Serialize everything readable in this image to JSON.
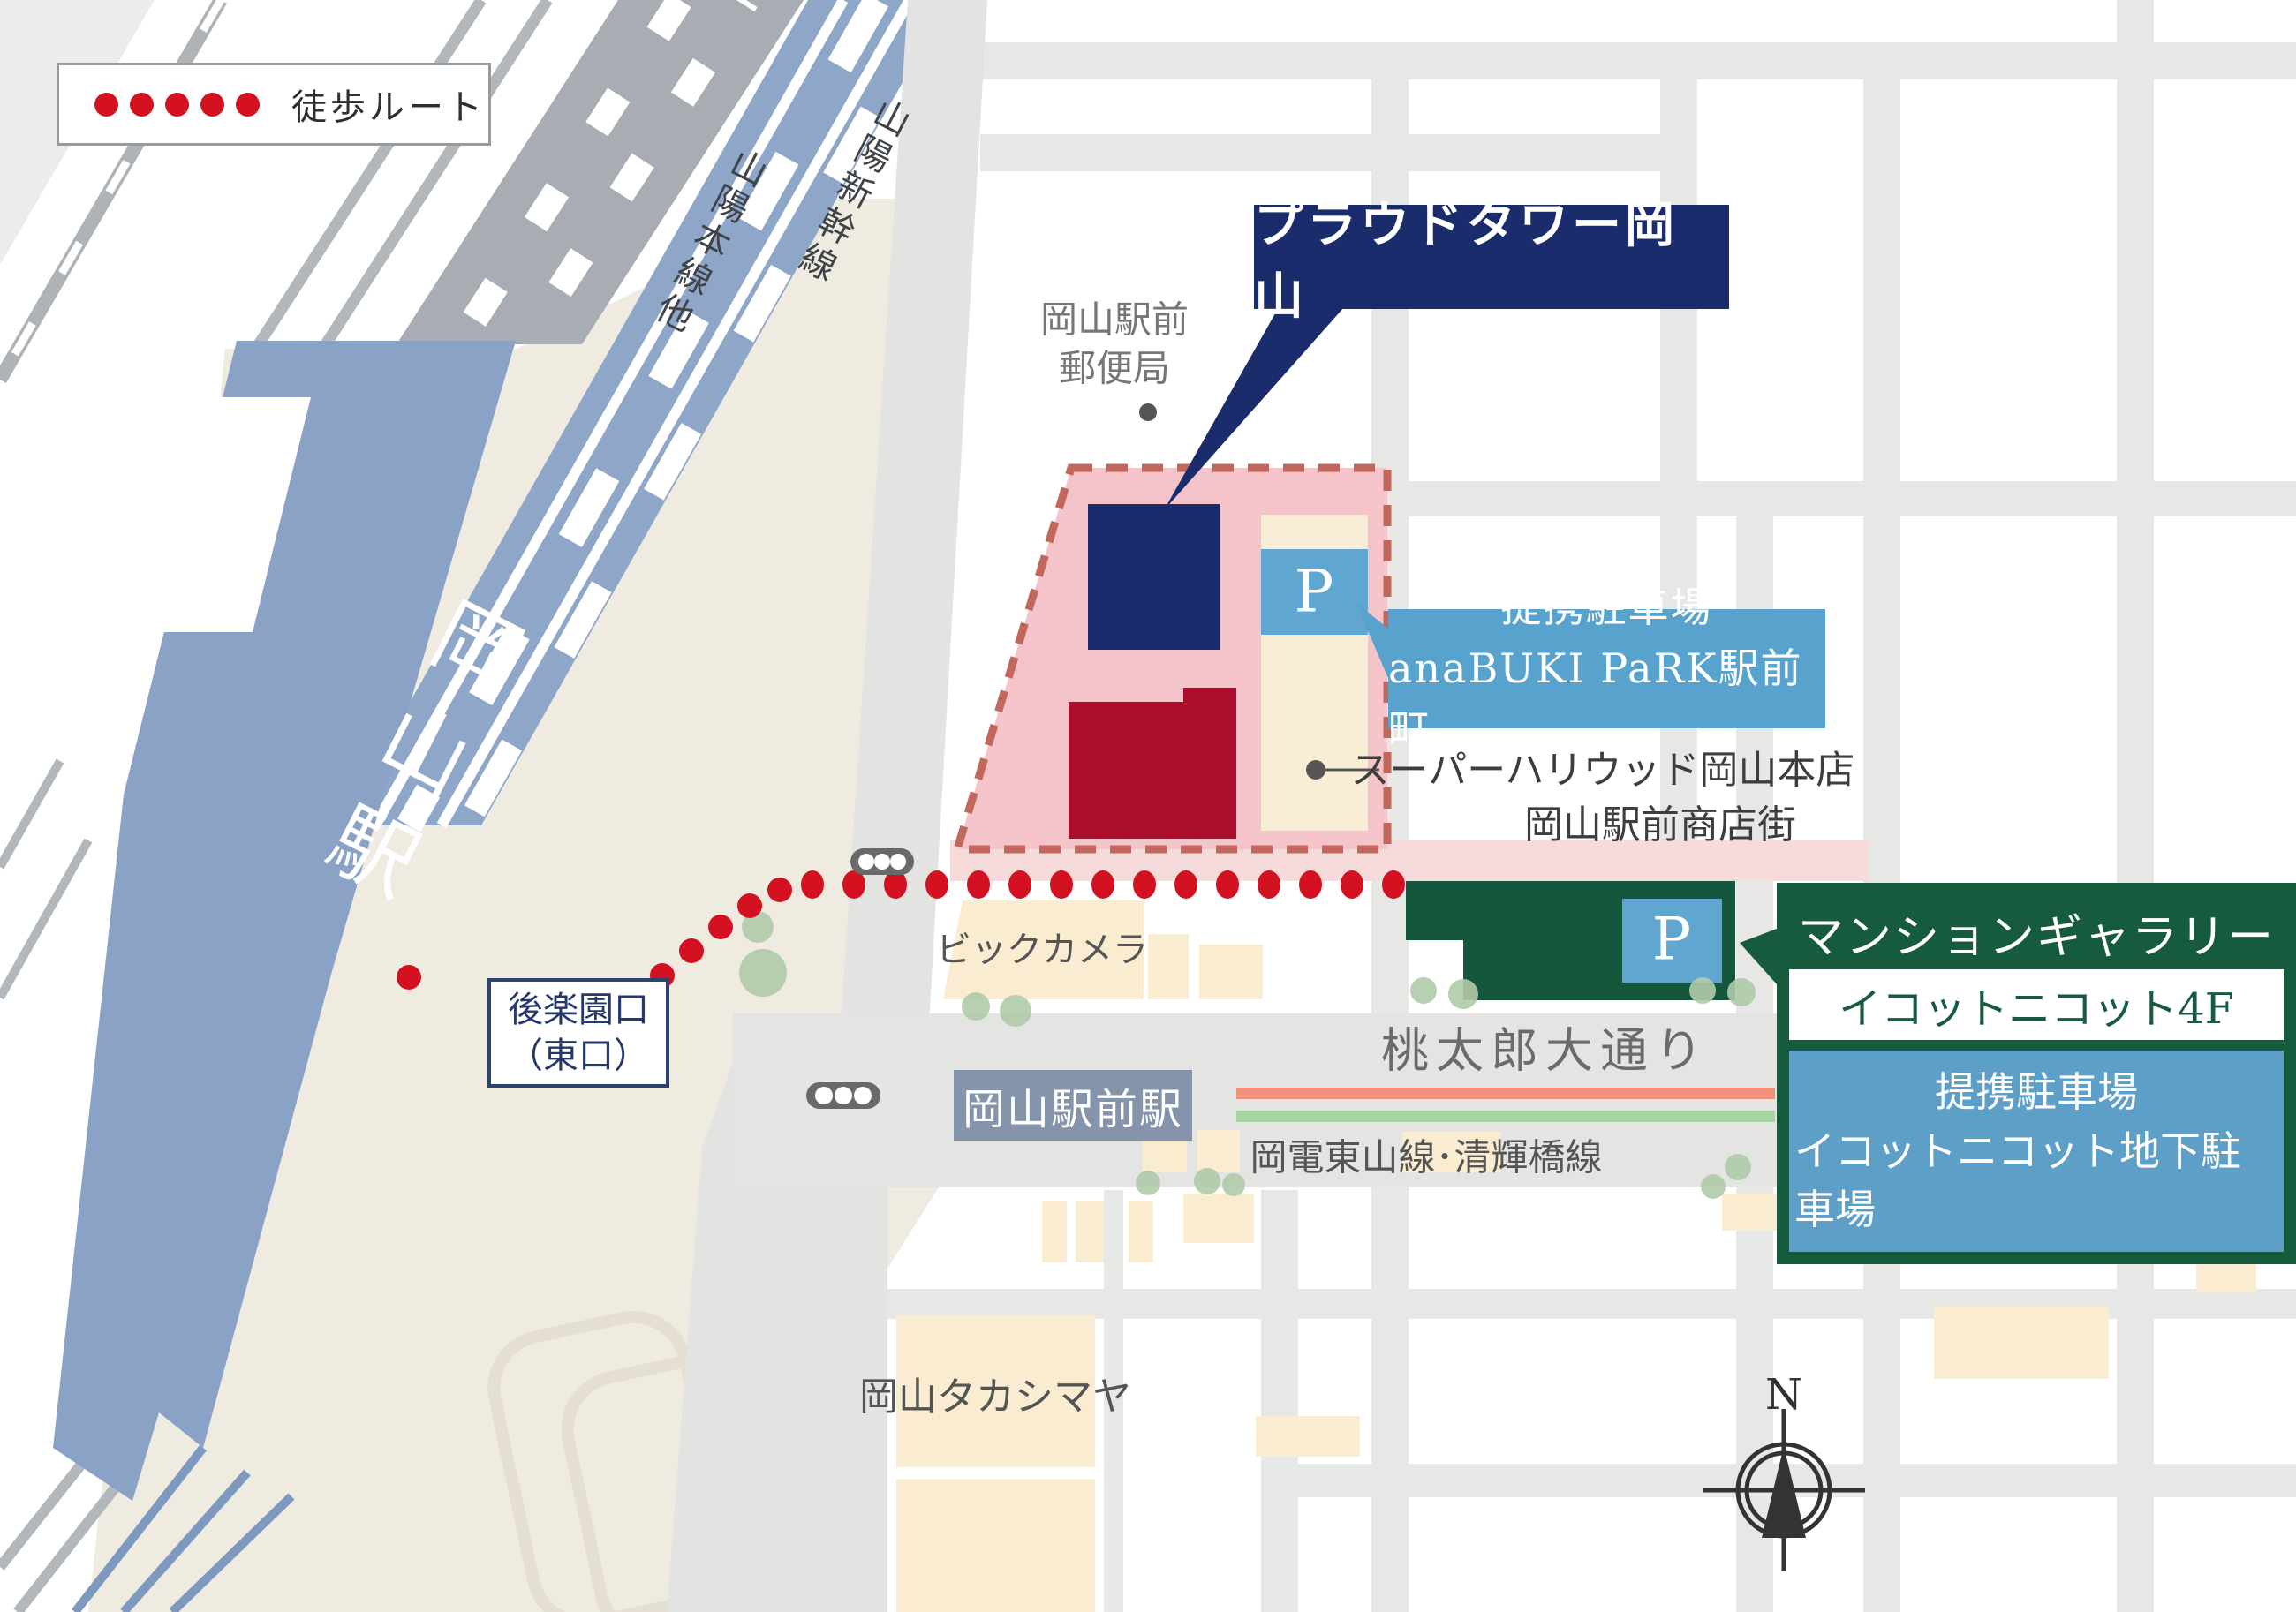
{
  "legend": {
    "walk_route_label": "徒歩ルート"
  },
  "compass": {
    "north_label": "N"
  },
  "station_area": {
    "okayama_station": "岡山駅",
    "sanyo_main_line": "山陽本線他",
    "sanyo_shinkansen": "山陽新幹線",
    "korakuen_exit_line1": "後楽園口",
    "korakuen_exit_line2": "（東口）"
  },
  "site": {
    "tower_label": "プラウドタワー岡山",
    "parking_p": "P",
    "partner_parking_line1": "提携駐車場",
    "partner_parking_line2": "anaBUKI PaRK駅前町",
    "supermarket": "スーパーハリウッド岡山本店",
    "shopping_street": "岡山駅前商店街",
    "post_office_line1": "岡山駅前",
    "post_office_line2": "郵便局"
  },
  "gallery": {
    "title": "マンションギャラリー",
    "location": "イコットニコット4F",
    "parking_line1": "提携駐車場",
    "parking_line2": "イコットニコット地下駐車場",
    "parking_p": "P"
  },
  "streets": {
    "momotaro_avenue": "桃太郎大通り",
    "tram_lines": "岡電東山線･清輝橋線",
    "ekimae_station": "岡山駅前駅"
  },
  "buildings": {
    "bic_camera": "ビックカメラ",
    "takashimaya": "岡山タカシマヤ"
  },
  "colors": {
    "route_red": "#d31120",
    "site_pink": "#f5c3ca",
    "site_border": "#c2675b",
    "navy": "#1a2c6b",
    "crimson": "#ac0f2e",
    "parking_blue": "#5fa7d1",
    "gallery_green": "#165b3e",
    "station_blue": "#8aa2c6",
    "tram_salmon": "#f2907b",
    "tram_green": "#a5d6a2",
    "building_cream": "#f9ecd1",
    "forecourt_beige": "#f0ebe0",
    "road_gray": "#e7e7e5"
  }
}
